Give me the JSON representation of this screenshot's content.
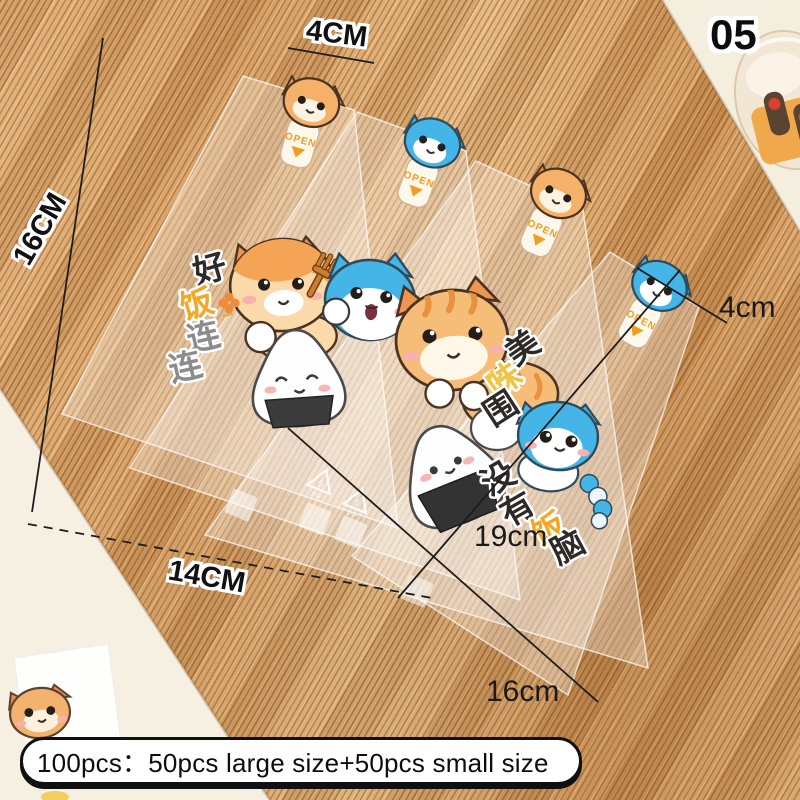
{
  "badge": {
    "number": "05"
  },
  "measurements": {
    "large_top_width": "4CM",
    "large_length": "16CM",
    "large_bottom_width": "14CM",
    "small_top_width": "4cm",
    "small_length": "19cm",
    "small_bottom_width": "16cm"
  },
  "caption": "100pcs：50pcs large size+50pcs small size",
  "sticker": {
    "open_label": "OPEN"
  },
  "slogan_left": {
    "chars": [
      "好",
      "饭",
      "连",
      "连"
    ]
  },
  "slogan_right": {
    "chars": [
      "美",
      "味",
      "围",
      "没",
      "有",
      "饭",
      "脑"
    ]
  },
  "recycle_mark": {
    "code": "5",
    "material": "PP"
  },
  "colors": {
    "label_ink": "#111111",
    "accent_orange": "#f49c1c",
    "slogan_orange": "#f5a623",
    "slogan_gray": "#8c8c8c",
    "slogan_yellow": "#f0c245",
    "cat_blue": "#45b4e6",
    "cat_orange": "#f5b169",
    "mat_base": "#d8a467"
  }
}
